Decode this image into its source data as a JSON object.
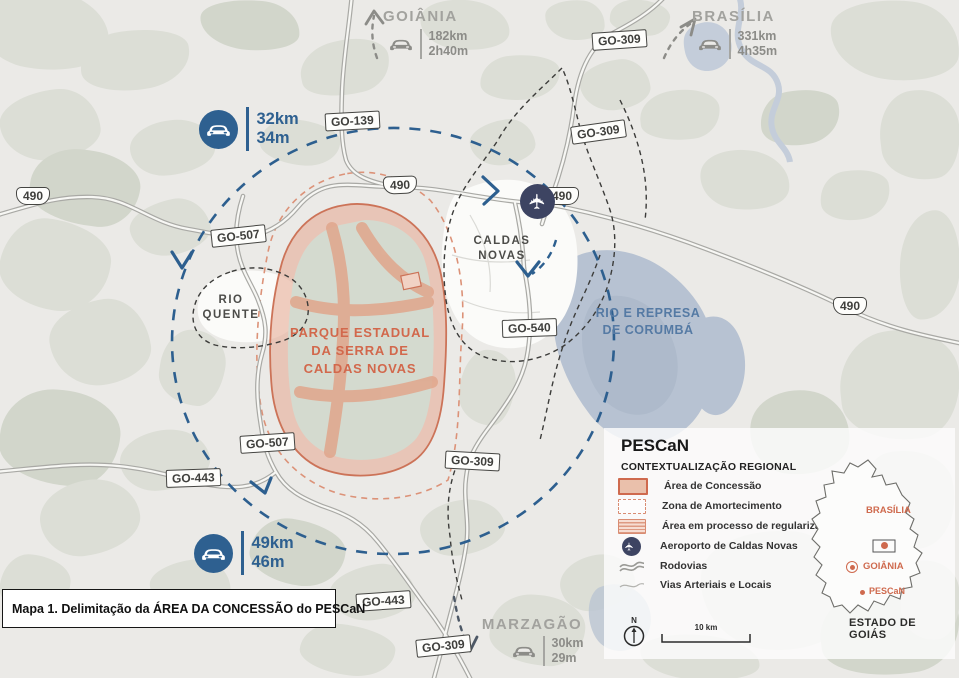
{
  "title_box": "Mapa 1. Delimitação da ÁREA DA CONCESSÃO do PESCaN",
  "icons": {
    "plane": "✈"
  },
  "destinations": {
    "goiania": {
      "name": "GOIÂNIA",
      "distance": "182km",
      "time": "2h40m"
    },
    "brasilia": {
      "name": "BRASÍLIA",
      "distance": "331km",
      "time": "4h35m"
    },
    "marzagao": {
      "name": "MARZAGÃO",
      "distance": "30km",
      "time": "29m"
    }
  },
  "travel_badges": {
    "north": {
      "distance": "32km",
      "time": "34m"
    },
    "south": {
      "distance": "49km",
      "time": "46m"
    }
  },
  "places": {
    "caldas_novas": {
      "line1": "CALDAS",
      "line2": "NOVAS"
    },
    "rio_quente": {
      "line1": "RIO",
      "line2": "QUENTE"
    },
    "park": {
      "line1": "PARQUE ESTADUAL",
      "line2": "DA SERRA DE",
      "line3": "CALDAS NOVAS"
    },
    "water": {
      "line1": "RIO E REPRESA",
      "line2": "DE CORUMBÁ"
    }
  },
  "road_labels": [
    {
      "text": "GO-139"
    },
    {
      "text": "GO-309"
    },
    {
      "text": "GO-309"
    },
    {
      "text": "490"
    },
    {
      "text": "490"
    },
    {
      "text": "490"
    },
    {
      "text": "490"
    },
    {
      "text": "GO-507"
    },
    {
      "text": "GO-540"
    },
    {
      "text": "GO-507"
    },
    {
      "text": "GO-443"
    },
    {
      "text": "GO-309"
    },
    {
      "text": "GO-443"
    },
    {
      "text": "GO-309"
    }
  ],
  "legend": {
    "title": "PESCaN",
    "subtitle": "CONTEXTUALIZAÇÃO REGIONAL",
    "items": [
      {
        "label": "Área de Concessão"
      },
      {
        "label": "Zona de Amortecimento"
      },
      {
        "label": "Área em processo de regularização"
      },
      {
        "label": "Aeroporto de Caldas Novas"
      },
      {
        "label": "Rodovias"
      },
      {
        "label": "Vias Arteriais e Locais"
      }
    ],
    "north_label": "N",
    "scale_label": "10 km",
    "inset": {
      "brasilia": "BRASÍLIA",
      "goiania": "GOIÂNIA",
      "pescan": "PESCaN",
      "state": "ESTADO DE GOIÁS"
    }
  },
  "colors": {
    "accent_blue": "#2e6090",
    "accent_orange": "#cf6a4e",
    "airport_navy": "#3d4462",
    "water_blue": "#b7c2d2"
  }
}
